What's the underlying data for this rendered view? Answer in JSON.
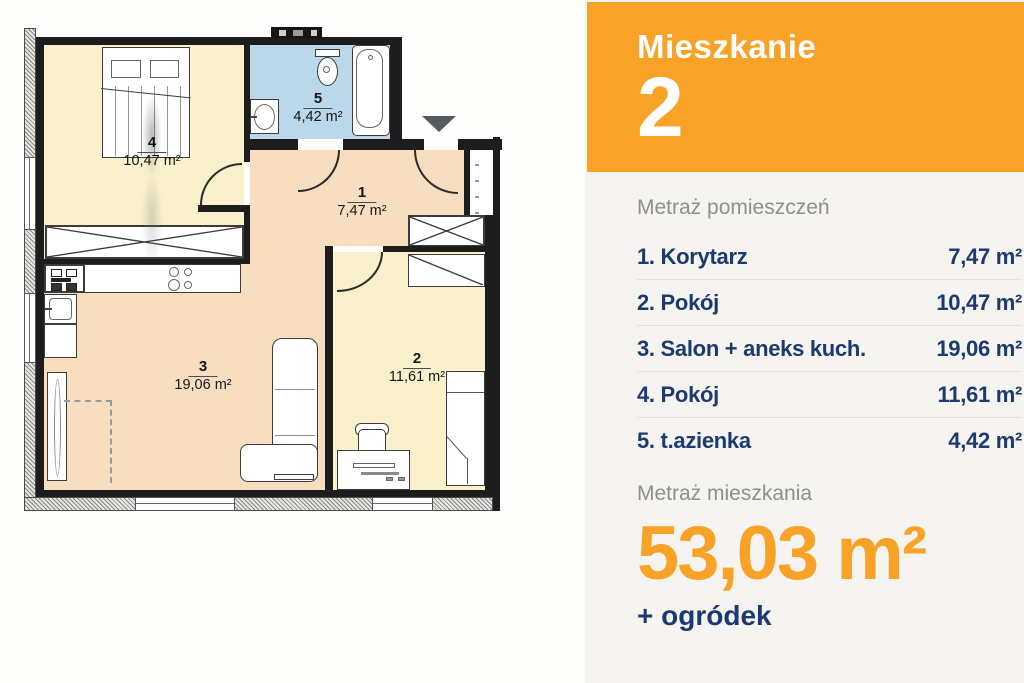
{
  "floorplan": {
    "rooms": [
      {
        "number": "4",
        "area": "10,47 m²"
      },
      {
        "number": "5",
        "area": "4,42 m²"
      },
      {
        "number": "1",
        "area": "7,47 m²"
      },
      {
        "number": "3",
        "area": "19,06 m²"
      },
      {
        "number": "2",
        "area": "11,61 m²"
      }
    ],
    "colors": {
      "room_yellow": "#FAF0CB",
      "room_peach": "#F8DEC1",
      "bathroom_blue": "#BAD8E9",
      "wall": "#1D1D1D"
    }
  },
  "panel": {
    "card": {
      "title": "Mieszkanie",
      "number": "2"
    },
    "rooms_header": "Metraż pomieszczeń",
    "rooms": [
      {
        "name": "1. Korytarz",
        "area": "7,47 m²"
      },
      {
        "name": "2. Pokój",
        "area": "10,47 m²"
      },
      {
        "name": "3. Salon + aneks kuch.",
        "area": "19,06 m²"
      },
      {
        "name": "4. Pokój",
        "area": "11,61 m²"
      },
      {
        "name": "5. t.azienka",
        "area": "4,42 m²"
      }
    ],
    "total_header": "Metraż mieszkania",
    "total_area": "53,03 m²",
    "total_extra": "+ ogródek",
    "colors": {
      "accent_orange": "#F8A227",
      "navy": "#1C3A70",
      "muted_gray": "#8E8E8C"
    }
  }
}
